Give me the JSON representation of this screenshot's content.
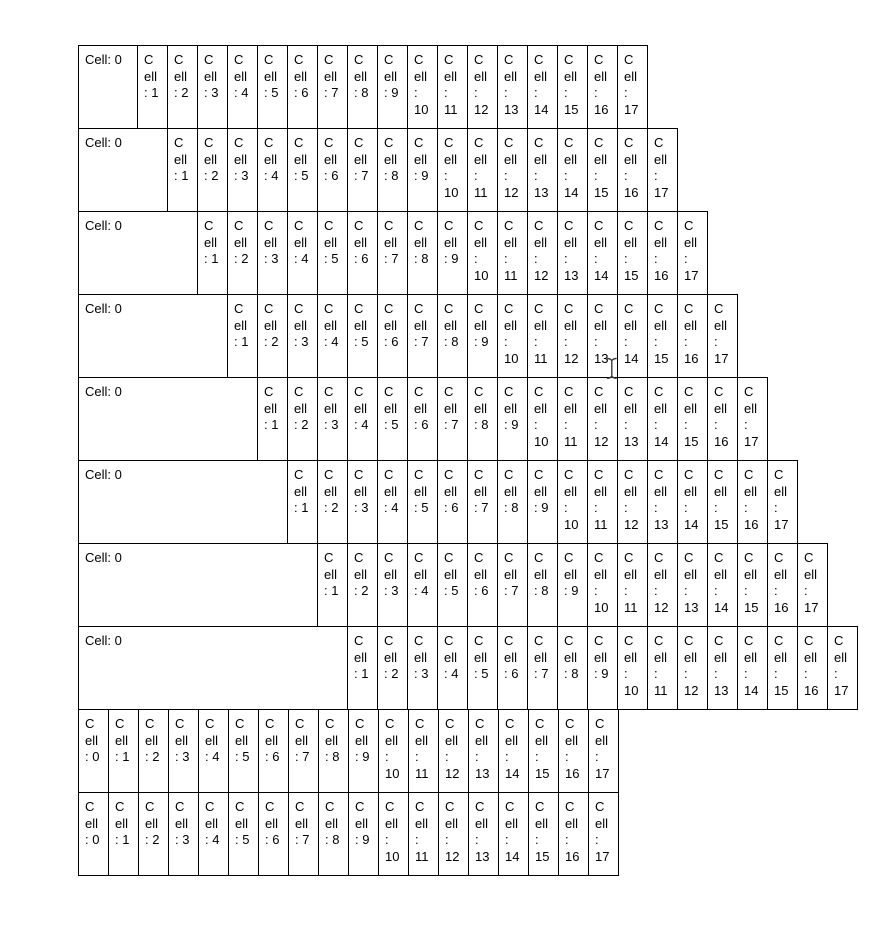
{
  "colors": {
    "background": "#ffffff",
    "cell_border": "#000000",
    "cell_text": "#000000"
  },
  "cursor": {
    "type": "text-ibeam",
    "x": 612,
    "y": 368
  },
  "table": {
    "rows": [
      {
        "first_cell_units": 2,
        "cells": [
          "Cell: 0",
          "C\nell\n: 1",
          "C\nell\n: 2",
          "C\nell\n: 3",
          "C\nell\n: 4",
          "C\nell\n: 5",
          "C\nell\n: 6",
          "C\nell\n: 7",
          "C\nell\n: 8",
          "C\nell\n: 9",
          "C\nell\n:\n10",
          "C\nell\n:\n11",
          "C\nell\n:\n12",
          "C\nell\n:\n13",
          "C\nell\n:\n14",
          "C\nell\n:\n15",
          "C\nell\n:\n16",
          "C\nell\n:\n17"
        ]
      },
      {
        "first_cell_units": 3,
        "cells": [
          "Cell: 0",
          "C\nell\n: 1",
          "C\nell\n: 2",
          "C\nell\n: 3",
          "C\nell\n: 4",
          "C\nell\n: 5",
          "C\nell\n: 6",
          "C\nell\n: 7",
          "C\nell\n: 8",
          "C\nell\n: 9",
          "C\nell\n:\n10",
          "C\nell\n:\n11",
          "C\nell\n:\n12",
          "C\nell\n:\n13",
          "C\nell\n:\n14",
          "C\nell\n:\n15",
          "C\nell\n:\n16",
          "C\nell\n:\n17"
        ]
      },
      {
        "first_cell_units": 4,
        "cells": [
          "Cell: 0",
          "C\nell\n: 1",
          "C\nell\n: 2",
          "C\nell\n: 3",
          "C\nell\n: 4",
          "C\nell\n: 5",
          "C\nell\n: 6",
          "C\nell\n: 7",
          "C\nell\n: 8",
          "C\nell\n: 9",
          "C\nell\n:\n10",
          "C\nell\n:\n11",
          "C\nell\n:\n12",
          "C\nell\n:\n13",
          "C\nell\n:\n14",
          "C\nell\n:\n15",
          "C\nell\n:\n16",
          "C\nell\n:\n17"
        ]
      },
      {
        "first_cell_units": 5,
        "cells": [
          "Cell: 0",
          "C\nell\n: 1",
          "C\nell\n: 2",
          "C\nell\n: 3",
          "C\nell\n: 4",
          "C\nell\n: 5",
          "C\nell\n: 6",
          "C\nell\n: 7",
          "C\nell\n: 8",
          "C\nell\n: 9",
          "C\nell\n:\n10",
          "C\nell\n:\n11",
          "C\nell\n:\n12",
          "C\nell\n:\n13",
          "C\nell\n:\n14",
          "C\nell\n:\n15",
          "C\nell\n:\n16",
          "C\nell\n:\n17"
        ]
      },
      {
        "first_cell_units": 6,
        "cells": [
          "Cell: 0",
          "C\nell\n: 1",
          "C\nell\n: 2",
          "C\nell\n: 3",
          "C\nell\n: 4",
          "C\nell\n: 5",
          "C\nell\n: 6",
          "C\nell\n: 7",
          "C\nell\n: 8",
          "C\nell\n: 9",
          "C\nell\n:\n10",
          "C\nell\n:\n11",
          "C\nell\n:\n12",
          "C\nell\n:\n13",
          "C\nell\n:\n14",
          "C\nell\n:\n15",
          "C\nell\n:\n16",
          "C\nell\n:\n17"
        ]
      },
      {
        "first_cell_units": 7,
        "cells": [
          "Cell: 0",
          "C\nell\n: 1",
          "C\nell\n: 2",
          "C\nell\n: 3",
          "C\nell\n: 4",
          "C\nell\n: 5",
          "C\nell\n: 6",
          "C\nell\n: 7",
          "C\nell\n: 8",
          "C\nell\n: 9",
          "C\nell\n:\n10",
          "C\nell\n:\n11",
          "C\nell\n:\n12",
          "C\nell\n:\n13",
          "C\nell\n:\n14",
          "C\nell\n:\n15",
          "C\nell\n:\n16",
          "C\nell\n:\n17"
        ]
      },
      {
        "first_cell_units": 8,
        "cells": [
          "Cell: 0",
          "C\nell\n: 1",
          "C\nell\n: 2",
          "C\nell\n: 3",
          "C\nell\n: 4",
          "C\nell\n: 5",
          "C\nell\n: 6",
          "C\nell\n: 7",
          "C\nell\n: 8",
          "C\nell\n: 9",
          "C\nell\n:\n10",
          "C\nell\n:\n11",
          "C\nell\n:\n12",
          "C\nell\n:\n13",
          "C\nell\n:\n14",
          "C\nell\n:\n15",
          "C\nell\n:\n16",
          "C\nell\n:\n17"
        ]
      },
      {
        "first_cell_units": 9,
        "cells": [
          "Cell: 0",
          "C\nell\n: 1",
          "C\nell\n: 2",
          "C\nell\n: 3",
          "C\nell\n: 4",
          "C\nell\n: 5",
          "C\nell\n: 6",
          "C\nell\n: 7",
          "C\nell\n: 8",
          "C\nell\n: 9",
          "C\nell\n:\n10",
          "C\nell\n:\n11",
          "C\nell\n:\n12",
          "C\nell\n:\n13",
          "C\nell\n:\n14",
          "C\nell\n:\n15",
          "C\nell\n:\n16",
          "C\nell\n:\n17"
        ]
      },
      {
        "first_cell_units": 1,
        "cells": [
          "C\nell\n: 0",
          "C\nell\n: 1",
          "C\nell\n: 2",
          "C\nell\n: 3",
          "C\nell\n: 4",
          "C\nell\n: 5",
          "C\nell\n: 6",
          "C\nell\n: 7",
          "C\nell\n: 8",
          "C\nell\n: 9",
          "C\nell\n:\n10",
          "C\nell\n:\n11",
          "C\nell\n:\n12",
          "C\nell\n:\n13",
          "C\nell\n:\n14",
          "C\nell\n:\n15",
          "C\nell\n:\n16",
          "C\nell\n:\n17"
        ]
      },
      {
        "first_cell_units": 1,
        "cells": [
          "C\nell\n: 0",
          "C\nell\n: 1",
          "C\nell\n: 2",
          "C\nell\n: 3",
          "C\nell\n: 4",
          "C\nell\n: 5",
          "C\nell\n: 6",
          "C\nell\n: 7",
          "C\nell\n: 8",
          "C\nell\n: 9",
          "C\nell\n:\n10",
          "C\nell\n:\n11",
          "C\nell\n:\n12",
          "C\nell\n:\n13",
          "C\nell\n:\n14",
          "C\nell\n:\n15",
          "C\nell\n:\n16",
          "C\nell\n:\n17"
        ]
      }
    ]
  }
}
